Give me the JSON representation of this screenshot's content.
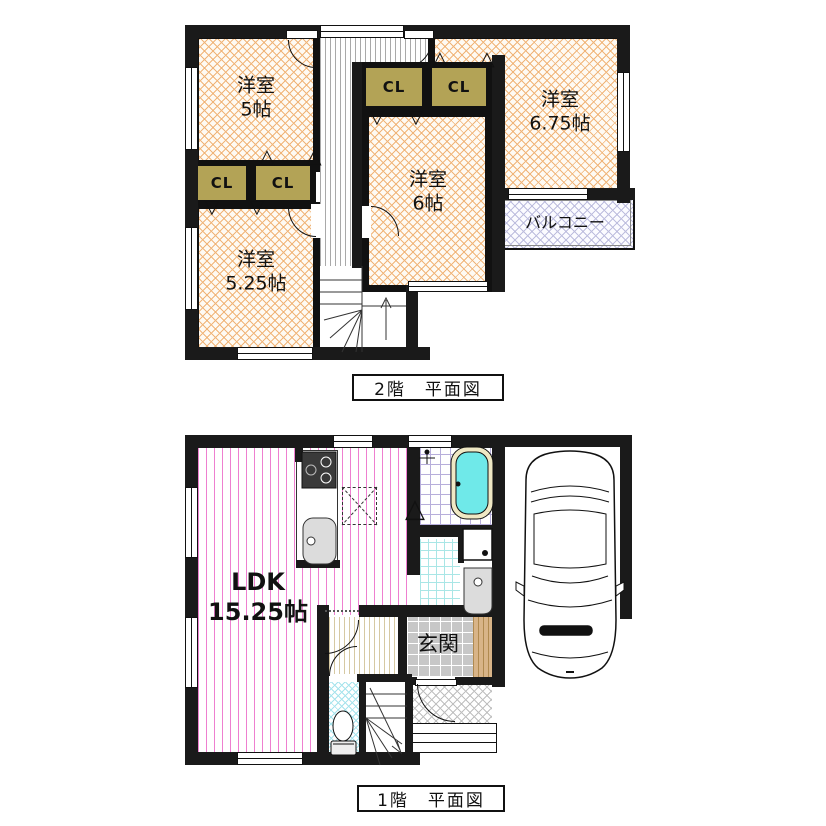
{
  "colors": {
    "wall": "#1a1a1a",
    "hatch_orange": "#F0B478",
    "room_bg": "#FEFAF3",
    "closet_fill": "#B3A356",
    "balcony_hatch": "#BDBDDE",
    "ldk_stripe": "#EE7FD0",
    "hall2_stripe": "#A9A9A9",
    "hall1_stripe": "#D6C9A2",
    "bath_tile": "#B7AEDB",
    "wash_grid": "#A9E6E6",
    "genkan_tile": "#C7C7C7",
    "wood_step": "#D8B488",
    "toilet_hatch": "#A5E3EC",
    "porch_hatch": "#BFBFBF",
    "tub_fill": "#6FE9E9",
    "tub_rim": "#EFE8C4",
    "fixture_gray": "#DCDCDC"
  },
  "floor2": {
    "caption": "2階　平面図",
    "closet_label": "CL",
    "rooms": {
      "yoshitsu5": {
        "name": "洋室",
        "size": "5帖"
      },
      "yoshitsu675": {
        "name": "洋室",
        "size": "6.75帖"
      },
      "yoshitsu6": {
        "name": "洋室",
        "size": "6帖"
      },
      "yoshitsu525": {
        "name": "洋室",
        "size": "5.25帖"
      },
      "balcony": {
        "name": "バルコニー"
      }
    }
  },
  "floor1": {
    "caption": "1階　平面図",
    "rooms": {
      "ldk": {
        "name": "LDK",
        "size": "15.25帖"
      },
      "genkan": {
        "name": "玄関"
      }
    }
  },
  "marks": {
    "fold_up": "△",
    "fold_down": "▽"
  }
}
